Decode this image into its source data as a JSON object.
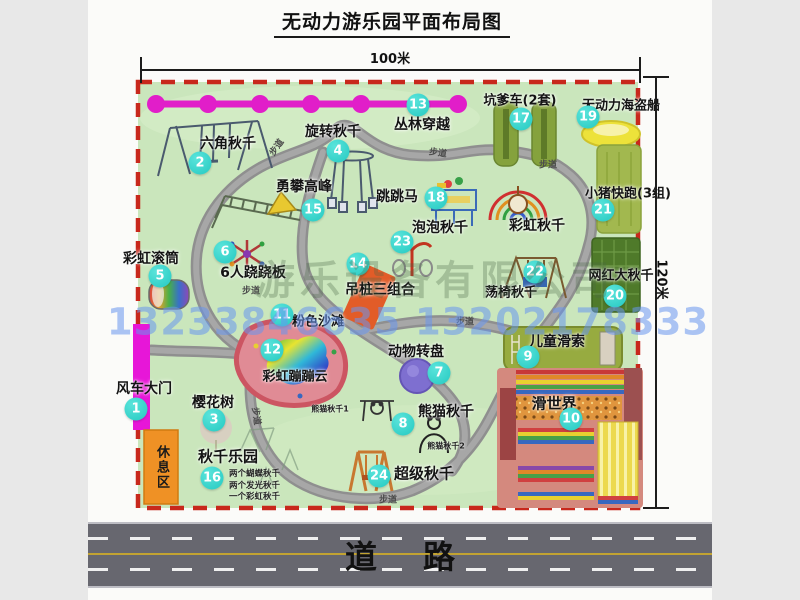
{
  "title": "无动力游乐园平面布局图",
  "dimensions": {
    "horizontal": "100米",
    "vertical": "120米"
  },
  "map": {
    "attractions": [
      {
        "num": "1",
        "name": "风车大门",
        "badge": [
          136,
          409
        ],
        "label": [
          144,
          388
        ],
        "size": 14
      },
      {
        "num": "2",
        "name": "六角秋千",
        "badge": [
          200,
          163
        ],
        "label": [
          228,
          143
        ],
        "size": 14
      },
      {
        "num": "3",
        "name": "樱花树",
        "badge": [
          214,
          420
        ],
        "label": [
          213,
          402
        ],
        "size": 14
      },
      {
        "num": "4",
        "name": "旋转秋千",
        "badge": [
          338,
          151
        ],
        "label": [
          333,
          131
        ],
        "size": 14
      },
      {
        "num": "5",
        "name": "彩虹滚筒",
        "badge": [
          160,
          276
        ],
        "label": [
          151,
          258
        ],
        "size": 14
      },
      {
        "num": "6",
        "name": "6人跷跷板",
        "badge": [
          225,
          252
        ],
        "label": [
          253,
          272
        ],
        "size": 14
      },
      {
        "num": "7",
        "name": "动物转盘",
        "badge": [
          439,
          373
        ],
        "label": [
          416,
          351
        ],
        "size": 14
      },
      {
        "num": "8",
        "name": "熊猫秋千",
        "badge": [
          403,
          424
        ],
        "label": [
          446,
          411
        ],
        "size": 14
      },
      {
        "num": "9",
        "name": "儿童滑索",
        "badge": [
          528,
          357
        ],
        "label": [
          557,
          341
        ],
        "size": 14
      },
      {
        "num": "10",
        "name": "滑世界",
        "badge": [
          571,
          419
        ],
        "label": [
          554,
          403
        ],
        "size": 15
      },
      {
        "num": "11",
        "name": "粉色沙滩",
        "badge": [
          282,
          315
        ],
        "label": [
          318,
          320
        ],
        "size": 13
      },
      {
        "num": "12",
        "name": "彩虹蹦蹦云",
        "badge": [
          272,
          350
        ],
        "label": [
          295,
          375
        ],
        "size": 13
      },
      {
        "num": "13",
        "name": "丛林穿越",
        "badge": [
          418,
          105
        ],
        "label": [
          422,
          124
        ],
        "size": 14
      },
      {
        "num": "14",
        "name": "吊桩三组合",
        "badge": [
          358,
          264
        ],
        "label": [
          380,
          289
        ],
        "size": 14
      },
      {
        "num": "15",
        "name": "勇攀高峰",
        "badge": [
          313,
          210
        ],
        "label": [
          304,
          186
        ],
        "size": 14
      },
      {
        "num": "16",
        "name": "秋千乐园",
        "badge": [
          212,
          478
        ],
        "label": [
          228,
          456
        ],
        "size": 15
      },
      {
        "num": "17",
        "name": "坑爹车(2套)",
        "badge": [
          521,
          119
        ],
        "label": [
          520,
          99
        ],
        "size": 13
      },
      {
        "num": "18",
        "name": "跳跳马",
        "badge": [
          436,
          198
        ],
        "label": [
          397,
          196
        ],
        "size": 14
      },
      {
        "num": "19",
        "name": "无动力海盗船",
        "badge": [
          588,
          117
        ],
        "label": [
          621,
          104
        ],
        "size": 13
      },
      {
        "num": "20",
        "name": "网红大秋千",
        "badge": [
          615,
          296
        ],
        "label": [
          621,
          274
        ],
        "size": 13
      },
      {
        "num": "21",
        "name": "小猪快跑(3组)",
        "badge": [
          603,
          210
        ],
        "label": [
          628,
          192
        ],
        "size": 13
      },
      {
        "num": "22",
        "name": "荡椅秋千",
        "badge": [
          535,
          272
        ],
        "label": [
          511,
          291
        ],
        "size": 13
      },
      {
        "num": "23",
        "name": "泡泡秋千",
        "badge": [
          402,
          242
        ],
        "label": [
          440,
          227
        ],
        "size": 14
      },
      {
        "num": "24",
        "name": "超级秋千",
        "badge": [
          379,
          476
        ],
        "label": [
          424,
          473
        ],
        "size": 15
      }
    ],
    "extra_labels": [
      {
        "text": "彩虹秋千",
        "x": 537,
        "y": 225,
        "size": 14
      },
      {
        "text": "熊猫秋千1",
        "x": 330,
        "y": 409,
        "size": 8
      },
      {
        "text": "熊猫秋千2",
        "x": 446,
        "y": 446,
        "size": 8
      }
    ],
    "swing_park_notes": [
      "两个蝴蝶秋千",
      "两个发光秋千",
      "一个彩虹秋千"
    ],
    "walkway_label": "步道",
    "walkway_label_positions": [
      {
        "x": 276,
        "y": 147,
        "rot": -55
      },
      {
        "x": 438,
        "y": 152,
        "rot": 8
      },
      {
        "x": 548,
        "y": 164,
        "rot": 0
      },
      {
        "x": 251,
        "y": 290,
        "rot": 0
      },
      {
        "x": 257,
        "y": 416,
        "rot": 82
      },
      {
        "x": 465,
        "y": 321,
        "rot": 0
      },
      {
        "x": 388,
        "y": 499,
        "rot": 0
      }
    ],
    "rest_area": "休息区"
  },
  "watermark": {
    "company": "游乐设备有限公司",
    "phone": "13233846635 13202178333"
  },
  "road": {
    "label": "道路"
  },
  "colors": {
    "badge": "#2fd5cd",
    "map_bg": "#cae6bc",
    "boundary_red": "#c8281c",
    "road_gray": "#67676f",
    "gate_magenta": "#e716d8"
  }
}
